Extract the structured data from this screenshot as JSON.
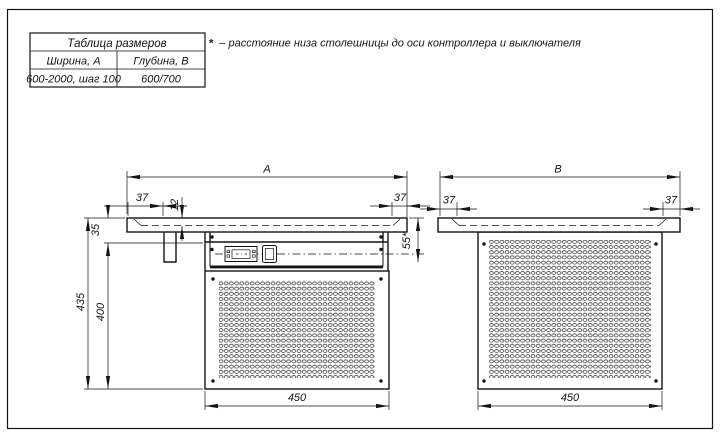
{
  "drawing": {
    "size_table": {
      "title": "Таблица размеров",
      "columns": [
        {
          "header": "Ширина, А",
          "value": "600-2000, шаг 100"
        },
        {
          "header": "Глубина, В",
          "value": "600/700"
        }
      ]
    },
    "footnote": {
      "marker": "*",
      "text": "– расстояние низа столешницы до оси контроллера и выключателя"
    },
    "front_view": {
      "dim_width": "А",
      "dim_overhang_left": "37",
      "dim_sheet_thickness": "12",
      "dim_tabletop_height": "35",
      "dim_total_height": "435",
      "dim_body_height": "400",
      "dim_panel_width": "450",
      "dim_overhang_right": "37",
      "dim_controller_axis": "55*"
    },
    "side_view": {
      "dim_depth": "В",
      "dim_overhang_left": "37",
      "dim_overhang_right": "37",
      "dim_panel_width": "450"
    },
    "colors": {
      "line": "#141414",
      "background": "#ffffff"
    }
  }
}
